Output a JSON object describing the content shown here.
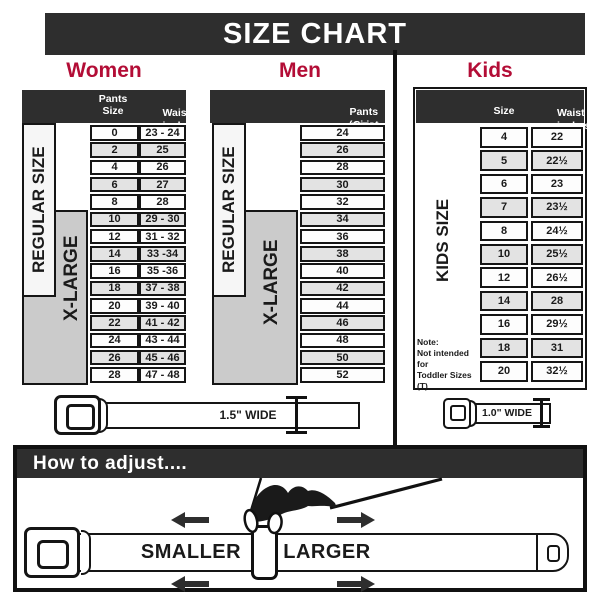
{
  "title": "SIZE CHART",
  "colors": {
    "accent": "#b30d36",
    "dark": "#2e2e2e",
    "xlarge_gray": "#cbcbcb",
    "alt_row": "#e3e3e3"
  },
  "women": {
    "heading": "Women",
    "col1_header": "Pants Size",
    "col2_header_line1": "Waist",
    "col2_header_line2": "inches",
    "regular_label": "REGULAR SIZE",
    "xlarge_label": "X-LARGE",
    "rows": [
      {
        "size": "0",
        "waist": "23 - 24"
      },
      {
        "size": "2",
        "waist": "25"
      },
      {
        "size": "4",
        "waist": "26"
      },
      {
        "size": "6",
        "waist": "27"
      },
      {
        "size": "8",
        "waist": "28"
      },
      {
        "size": "10",
        "waist": "29 - 30"
      },
      {
        "size": "12",
        "waist": "31 - 32"
      },
      {
        "size": "14",
        "waist": "33 -34"
      },
      {
        "size": "16",
        "waist": "35 -36"
      },
      {
        "size": "18",
        "waist": "37 - 38"
      },
      {
        "size": "20",
        "waist": "39 - 40"
      },
      {
        "size": "22",
        "waist": "41 - 42"
      },
      {
        "size": "24",
        "waist": "43 - 44"
      },
      {
        "size": "26",
        "waist": "45 - 46"
      },
      {
        "size": "28",
        "waist": "47 - 48"
      }
    ]
  },
  "men": {
    "heading": "Men",
    "header_line1": "Pants Size",
    "header_line2": "(waist inches)",
    "regular_label": "REGULAR SIZE",
    "xlarge_label": "X-LARGE",
    "rows": [
      "24",
      "26",
      "28",
      "30",
      "32",
      "34",
      "36",
      "38",
      "40",
      "42",
      "44",
      "46",
      "48",
      "50",
      "52"
    ]
  },
  "kids": {
    "heading": "Kids",
    "col1_header": "Size",
    "col2_header_line1": "Waist",
    "col2_header_line2": "inches",
    "side_label": "KIDS SIZE",
    "note_line1": "Note:",
    "note_line2": "Not intended for",
    "note_line3": "Toddler Sizes (T)",
    "rows": [
      {
        "size": "4",
        "waist": "22"
      },
      {
        "size": "5",
        "waist": "22½"
      },
      {
        "size": "6",
        "waist": "23"
      },
      {
        "size": "7",
        "waist": "23½"
      },
      {
        "size": "8",
        "waist": "24½"
      },
      {
        "size": "10",
        "waist": "25½"
      },
      {
        "size": "12",
        "waist": "26½"
      },
      {
        "size": "14",
        "waist": "28"
      },
      {
        "size": "16",
        "waist": "29½"
      },
      {
        "size": "18",
        "waist": "31"
      },
      {
        "size": "20",
        "waist": "32½"
      }
    ]
  },
  "belts": {
    "adult_width_label": "1.5\" WIDE",
    "kids_width_label": "1.0\" WIDE"
  },
  "adjust": {
    "heading": "How to adjust....",
    "smaller_label": "SMALLER",
    "larger_label": "LARGER"
  }
}
